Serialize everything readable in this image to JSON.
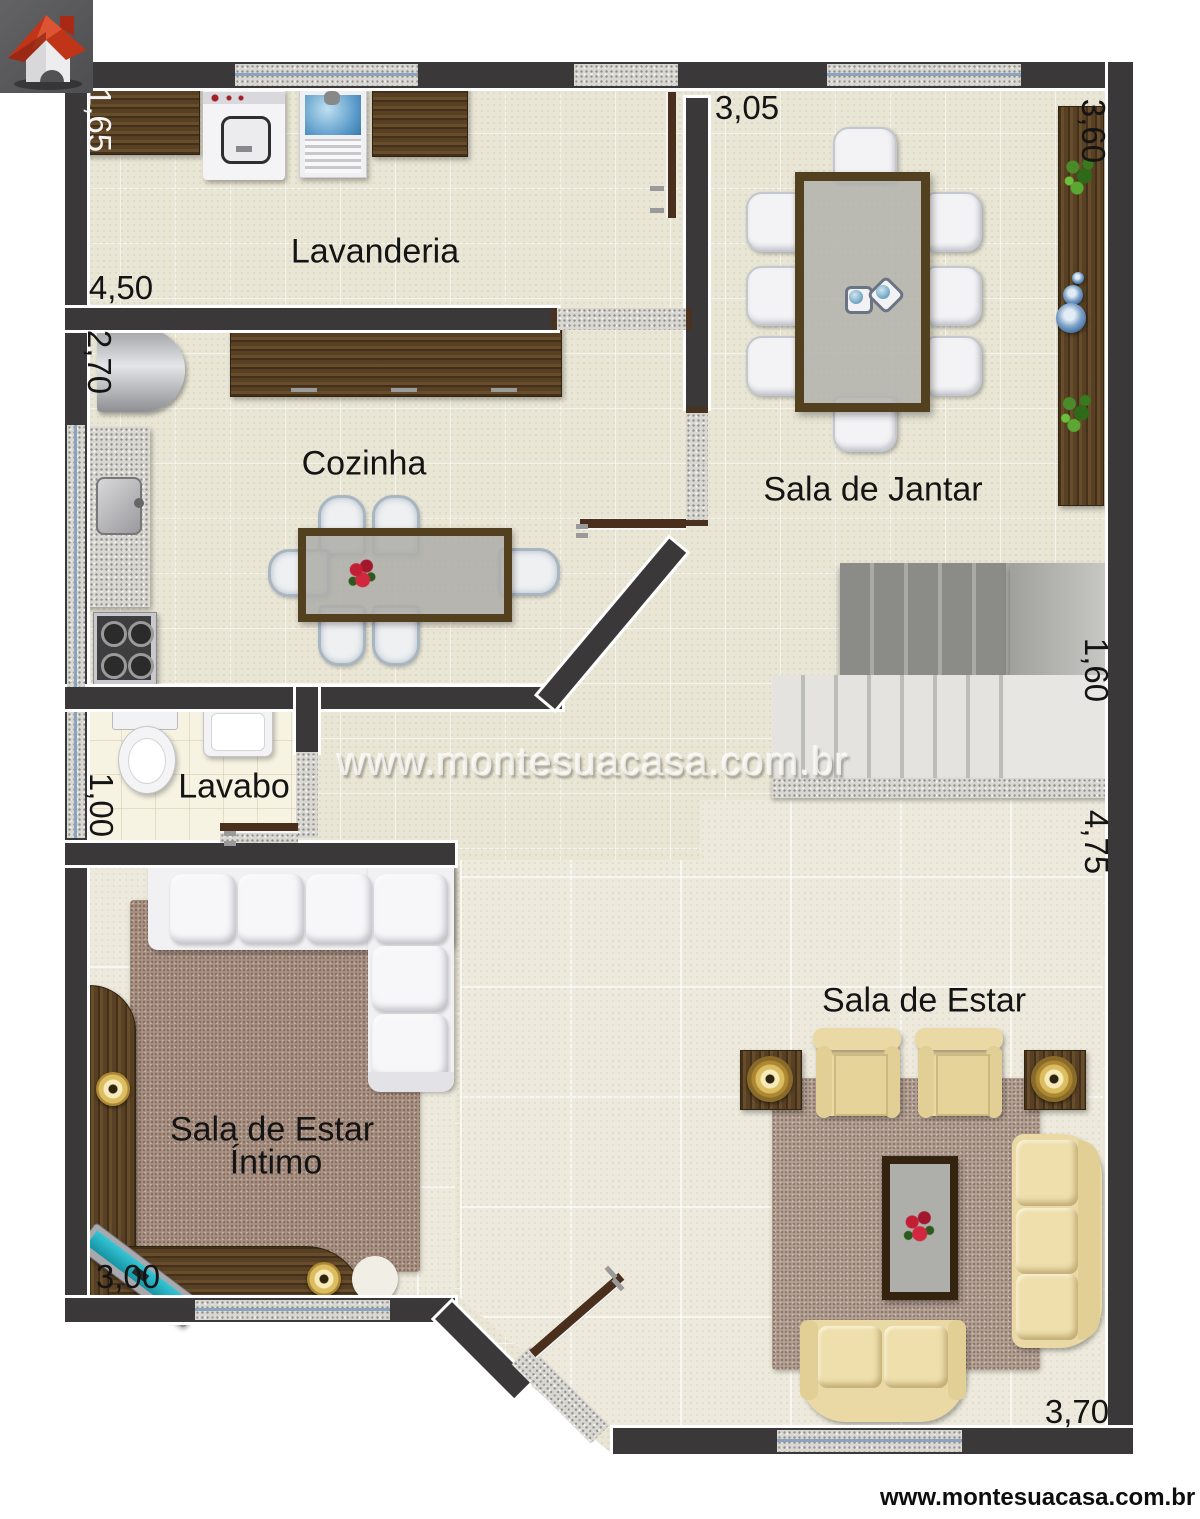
{
  "watermark": {
    "center": "www.montesuacasa.com.br",
    "bottom": "www.montesuacasa.com.br"
  },
  "rooms": {
    "lavanderia": "Lavanderia",
    "cozinha": "Cozinha",
    "sala_de_jantar": "Sala de Jantar",
    "lavabo": "Lavabo",
    "sala_intimo_1": "Sala de Estar",
    "sala_intimo_2": "Íntimo",
    "sala_de_estar": "Sala de Estar"
  },
  "dims": {
    "laundry_side": "1,65",
    "laundry_front": "4,50",
    "kitchen_side": "2,70",
    "dining_front": "3,05",
    "dining_side": "3,60",
    "stairs_side": "1,60",
    "living_side": "4,75",
    "lavabo_side": "1,00",
    "intimo_front": "3,00",
    "living_front": "3,70"
  },
  "icons": {
    "logo": "house-logo"
  },
  "colors": {
    "wall": "#3b383a",
    "floor_tile": "#e9e6d6",
    "floor_social": "#edeadd",
    "floor_lavabo": "#f6f3e2",
    "wood_dark": "#5d4527",
    "granite": "#d8d7d2",
    "window_glass": "#8ba3bf",
    "rug_mauve": "#a89183",
    "rug_living": "#b3a093",
    "sofa_white": "#f6f6f8",
    "sofa_cream": "#ead9a4",
    "tv_screen": "#28b7c7",
    "gold": "#d9b95e",
    "flower_red": "#c2213a",
    "plant_green": "#3f7d20",
    "logo_red": "#c03418",
    "logo_bg": "#58585a"
  }
}
